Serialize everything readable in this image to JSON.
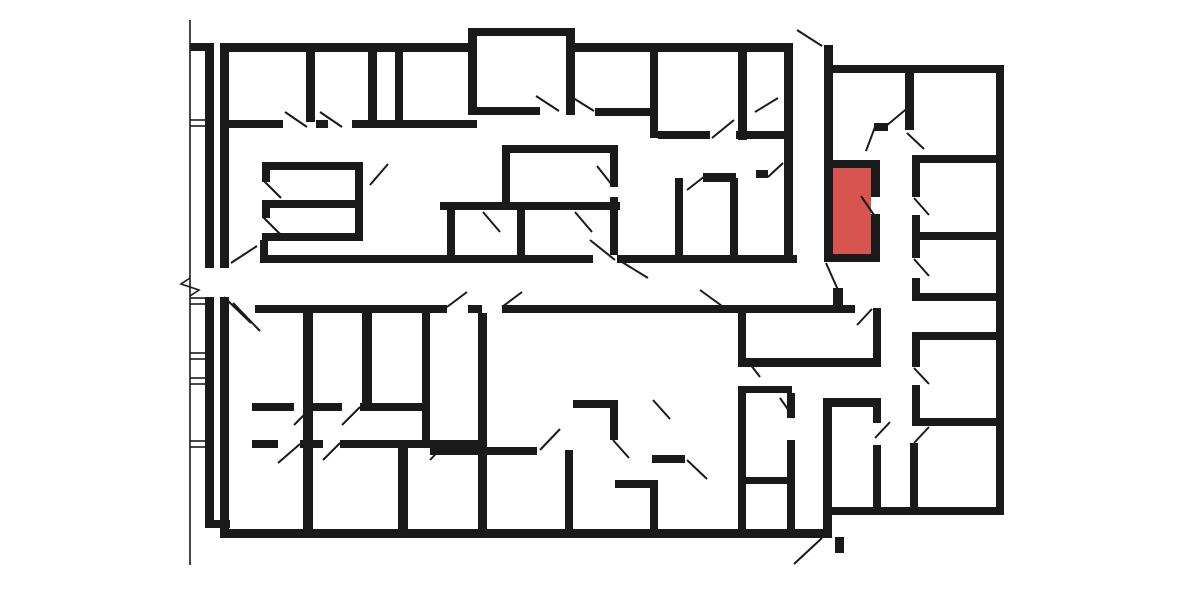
{
  "canvas": {
    "width": 1184,
    "height": 592,
    "bg": "#ffffff"
  },
  "palette": {
    "wall": "#1a1a1a",
    "door_line": "#1a1a1a",
    "thin_line": "#1a1a1a",
    "highlight": "#d8544e"
  },
  "floorplan": {
    "walls": [
      [
        190,
        43,
        24,
        8
      ],
      [
        205,
        45,
        9,
        223
      ],
      [
        205,
        297,
        9,
        231
      ],
      [
        205,
        520,
        25,
        8
      ],
      [
        220,
        43,
        9,
        225
      ],
      [
        220,
        297,
        9,
        241
      ],
      [
        220,
        43,
        252,
        9
      ],
      [
        468,
        28,
        9,
        87
      ],
      [
        468,
        28,
        107,
        8
      ],
      [
        566,
        28,
        9,
        87
      ],
      [
        575,
        43,
        218,
        9
      ],
      [
        784,
        43,
        9,
        219
      ],
      [
        824,
        45,
        9,
        117
      ],
      [
        825,
        65,
        179,
        8
      ],
      [
        996,
        65,
        8,
        450
      ],
      [
        824,
        507,
        180,
        8
      ],
      [
        220,
        529,
        612,
        9
      ],
      [
        823,
        398,
        9,
        139
      ],
      [
        306,
        52,
        9,
        70
      ],
      [
        368,
        52,
        9,
        70
      ],
      [
        395,
        52,
        8,
        70
      ],
      [
        224,
        120,
        59,
        8
      ],
      [
        316,
        120,
        12,
        8
      ],
      [
        352,
        120,
        125,
        8
      ],
      [
        477,
        107,
        63,
        8
      ],
      [
        595,
        108,
        63,
        8
      ],
      [
        650,
        52,
        8,
        86
      ],
      [
        738,
        52,
        9,
        88
      ],
      [
        658,
        131,
        52,
        8
      ],
      [
        736,
        131,
        12,
        8
      ],
      [
        748,
        131,
        36,
        8
      ],
      [
        262,
        162,
        100,
        8
      ],
      [
        262,
        200,
        100,
        8
      ],
      [
        262,
        233,
        100,
        8
      ],
      [
        355,
        162,
        8,
        79
      ],
      [
        262,
        170,
        8,
        12
      ],
      [
        262,
        208,
        8,
        10
      ],
      [
        502,
        145,
        115,
        8
      ],
      [
        502,
        145,
        8,
        65
      ],
      [
        440,
        202,
        180,
        8
      ],
      [
        610,
        145,
        8,
        42
      ],
      [
        610,
        197,
        8,
        13
      ],
      [
        447,
        210,
        8,
        45
      ],
      [
        517,
        210,
        8,
        45
      ],
      [
        610,
        210,
        8,
        45
      ],
      [
        260,
        240,
        8,
        23
      ],
      [
        260,
        255,
        333,
        8
      ],
      [
        617,
        255,
        180,
        8
      ],
      [
        255,
        305,
        192,
        8
      ],
      [
        468,
        305,
        14,
        8
      ],
      [
        502,
        305,
        330,
        8
      ],
      [
        832,
        305,
        23,
        8
      ],
      [
        303,
        313,
        10,
        216
      ],
      [
        362,
        313,
        10,
        97
      ],
      [
        422,
        313,
        8,
        134
      ],
      [
        252,
        403,
        42,
        8
      ],
      [
        312,
        403,
        30,
        8
      ],
      [
        360,
        403,
        67,
        8
      ],
      [
        252,
        440,
        26,
        8
      ],
      [
        300,
        440,
        23,
        8
      ],
      [
        340,
        440,
        138,
        8
      ],
      [
        398,
        448,
        10,
        81
      ],
      [
        478,
        313,
        9,
        216
      ],
      [
        430,
        447,
        107,
        8
      ],
      [
        565,
        450,
        8,
        79
      ],
      [
        573,
        400,
        45,
        8
      ],
      [
        610,
        400,
        8,
        40
      ],
      [
        615,
        480,
        43,
        8
      ],
      [
        650,
        488,
        8,
        41
      ],
      [
        652,
        455,
        33,
        8
      ],
      [
        738,
        313,
        8,
        54
      ],
      [
        738,
        386,
        8,
        143
      ],
      [
        740,
        477,
        55,
        7
      ],
      [
        787,
        393,
        8,
        25
      ],
      [
        787,
        440,
        8,
        89
      ],
      [
        745,
        386,
        47,
        7
      ],
      [
        745,
        358,
        136,
        9
      ],
      [
        675,
        178,
        8,
        77
      ],
      [
        730,
        178,
        8,
        77
      ],
      [
        703,
        173,
        33,
        9
      ],
      [
        756,
        170,
        12,
        8
      ],
      [
        824,
        160,
        9,
        102
      ],
      [
        824,
        160,
        56,
        8
      ],
      [
        871,
        168,
        9,
        29
      ],
      [
        871,
        214,
        9,
        40
      ],
      [
        824,
        254,
        56,
        8
      ],
      [
        833,
        288,
        10,
        18
      ],
      [
        835,
        537,
        9,
        16
      ],
      [
        905,
        73,
        9,
        57
      ],
      [
        874,
        123,
        14,
        8
      ],
      [
        912,
        155,
        84,
        8
      ],
      [
        912,
        232,
        84,
        8
      ],
      [
        912,
        293,
        84,
        8
      ],
      [
        912,
        332,
        84,
        8
      ],
      [
        912,
        418,
        84,
        8
      ],
      [
        912,
        155,
        8,
        42
      ],
      [
        912,
        215,
        8,
        25
      ],
      [
        912,
        240,
        8,
        18
      ],
      [
        912,
        278,
        8,
        23
      ],
      [
        912,
        340,
        8,
        27
      ],
      [
        912,
        385,
        8,
        41
      ],
      [
        910,
        443,
        8,
        64
      ],
      [
        873,
        308,
        8,
        57
      ],
      [
        831,
        398,
        50,
        9
      ],
      [
        873,
        398,
        8,
        25
      ],
      [
        873,
        445,
        8,
        62
      ]
    ],
    "door_swings": [
      [
        231,
        263,
        257,
        246
      ],
      [
        224,
        297,
        251,
        323
      ],
      [
        233,
        303,
        260,
        331
      ],
      [
        285,
        112,
        307,
        127
      ],
      [
        320,
        112,
        342,
        127
      ],
      [
        536,
        96,
        559,
        111
      ],
      [
        570,
        96,
        594,
        111
      ],
      [
        712,
        138,
        734,
        120
      ],
      [
        755,
        112,
        778,
        98
      ],
      [
        797,
        30,
        822,
        46
      ],
      [
        886,
        126,
        910,
        106
      ],
      [
        866,
        151,
        875,
        127
      ],
      [
        907,
        133,
        924,
        149
      ],
      [
        263,
        180,
        281,
        198
      ],
      [
        263,
        217,
        281,
        235
      ],
      [
        370,
        185,
        388,
        164
      ],
      [
        612,
        185,
        597,
        166
      ],
      [
        483,
        212,
        500,
        232
      ],
      [
        575,
        212,
        592,
        232
      ],
      [
        590,
        240,
        615,
        260
      ],
      [
        622,
        262,
        648,
        278
      ],
      [
        447,
        307,
        467,
        292
      ],
      [
        502,
        307,
        522,
        292
      ],
      [
        700,
        290,
        722,
        306
      ],
      [
        687,
        190,
        705,
        176
      ],
      [
        768,
        177,
        783,
        163
      ],
      [
        874,
        215,
        861,
        196
      ],
      [
        826,
        263,
        838,
        290
      ],
      [
        857,
        325,
        872,
        309
      ],
      [
        914,
        198,
        929,
        215
      ],
      [
        914,
        259,
        929,
        276
      ],
      [
        914,
        368,
        929,
        384
      ],
      [
        929,
        427,
        914,
        443
      ],
      [
        875,
        438,
        890,
        422
      ],
      [
        780,
        398,
        794,
        418
      ],
      [
        747,
        360,
        760,
        377
      ],
      [
        294,
        425,
        312,
        407
      ],
      [
        342,
        425,
        360,
        407
      ],
      [
        278,
        463,
        300,
        444
      ],
      [
        323,
        460,
        340,
        443
      ],
      [
        430,
        460,
        447,
        442
      ],
      [
        540,
        450,
        560,
        429
      ],
      [
        613,
        440,
        629,
        458
      ],
      [
        653,
        400,
        670,
        419
      ],
      [
        687,
        460,
        707,
        479
      ],
      [
        822,
        538,
        794,
        564
      ]
    ],
    "thin_ticks": [
      [
        190,
        120,
        205,
        120
      ],
      [
        190,
        126,
        205,
        126
      ],
      [
        190,
        298,
        205,
        298
      ],
      [
        190,
        304,
        205,
        304
      ],
      [
        190,
        353,
        205,
        353
      ],
      [
        190,
        359,
        205,
        359
      ],
      [
        190,
        378,
        205,
        378
      ],
      [
        190,
        384,
        205,
        384
      ],
      [
        190,
        441,
        205,
        441
      ],
      [
        190,
        447,
        205,
        447
      ]
    ],
    "boundary_line": [
      190,
      20,
      190,
      565
    ],
    "break_symbol": [
      [
        190,
        278
      ],
      [
        181,
        284
      ],
      [
        199,
        290
      ],
      [
        190,
        296
      ]
    ],
    "highlight_room": {
      "x": 832,
      "y": 168,
      "w": 39,
      "h": 86
    }
  }
}
